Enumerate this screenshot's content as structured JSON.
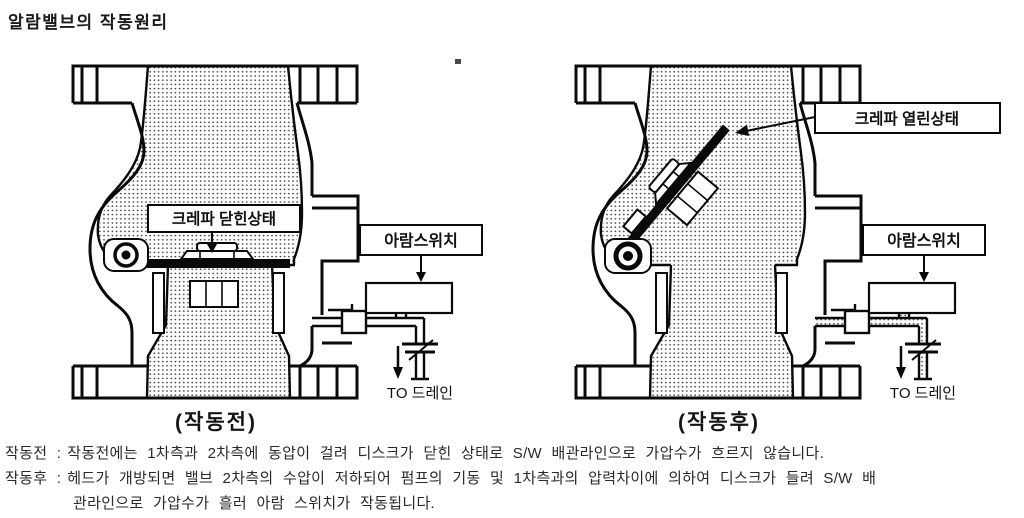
{
  "page": {
    "title": "알람밸브의 작동원리",
    "ink": "#0a0a0a",
    "background": "#ffffff"
  },
  "diagram_before": {
    "clapper_label": "크레파 닫힌상태",
    "switch_label": "아람스위치",
    "drain_label": "TO 드레인",
    "caption": "(작동전)",
    "state": "clapper-closed"
  },
  "diagram_after": {
    "clapper_label": "크레파 열린상태",
    "switch_label": "아람스위치",
    "drain_label": "TO 드레인",
    "caption": "(작동후)",
    "state": "clapper-open"
  },
  "description": {
    "before_label": "작동전 :",
    "before_text": "작동전에는 1차측과 2차측에 동압이 걸려 디스크가 닫힌 상태로 S/W 배관라인으로 가압수가 흐르지 않습니다.",
    "after_label": "작동후 :",
    "after_text": "헤드가 개방되면 밸브 2차측의 수압이 저하되어 펌프의 기동 및 1차측과의 압력차이에 의하여 디스크가 들려 S/W 배",
    "after_text2": "관라인으로 가압수가 흘러 아람 스위치가 작동됩니다."
  }
}
